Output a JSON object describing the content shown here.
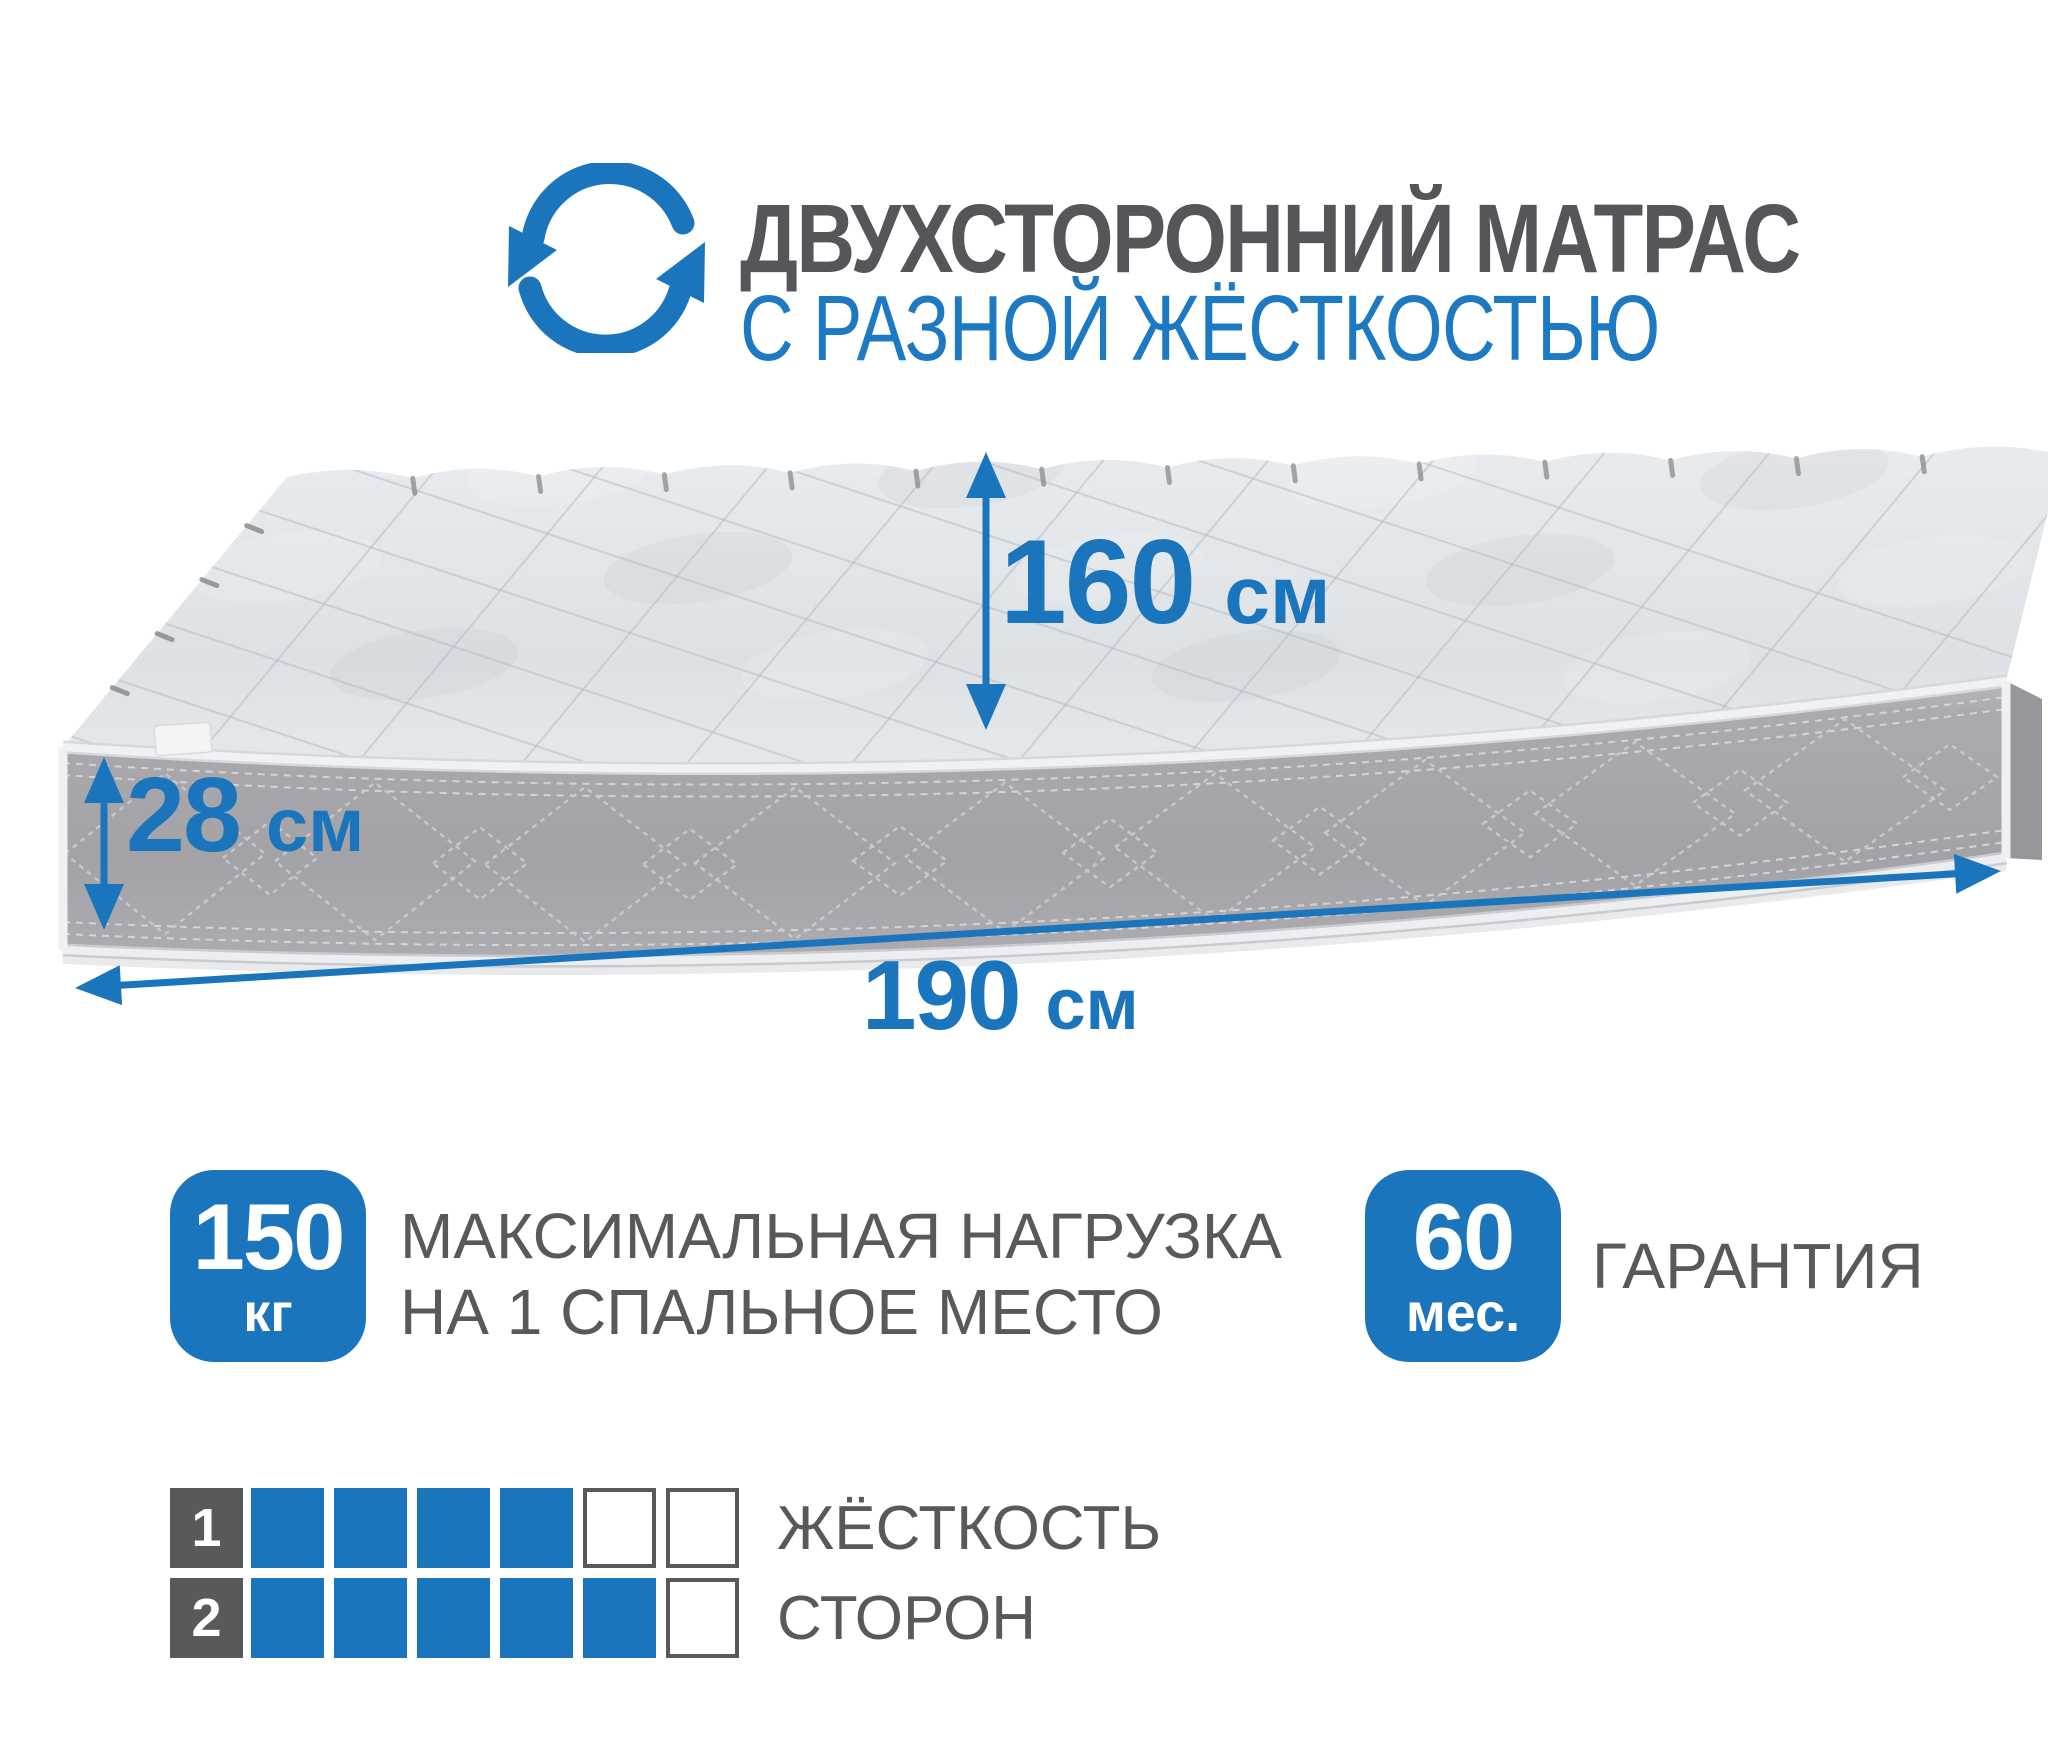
{
  "colors": {
    "accent": "#1b75bc",
    "gray": "#58595b"
  },
  "header": {
    "title_line1": "ДВУХСТОРОННИЙ МАТРАС",
    "title_line2": "С РАЗНОЙ ЖЁСТКОСТЬЮ"
  },
  "mattress_dimensions": {
    "width": {
      "value": "160",
      "unit": "см"
    },
    "height": {
      "value": "28",
      "unit": "см"
    },
    "length": {
      "value": "190",
      "unit": "см"
    }
  },
  "features": [
    {
      "badge": {
        "value": "150",
        "unit": "кг"
      },
      "label_line1": "МАКСИМАЛЬНАЯ НАГРУЗКА",
      "label_line2": "НА 1 СПАЛЬНОЕ МЕСТО"
    },
    {
      "badge": {
        "value": "60",
        "unit": "мес."
      },
      "label": "ГАРАНТИЯ"
    }
  ],
  "firmness_scale": {
    "rows": [
      {
        "index": "1",
        "filled": 4,
        "total": 6,
        "label": "ЖЁСТКОСТЬ"
      },
      {
        "index": "2",
        "filled": 5,
        "total": 6,
        "label": "СТОРОН"
      }
    ]
  }
}
